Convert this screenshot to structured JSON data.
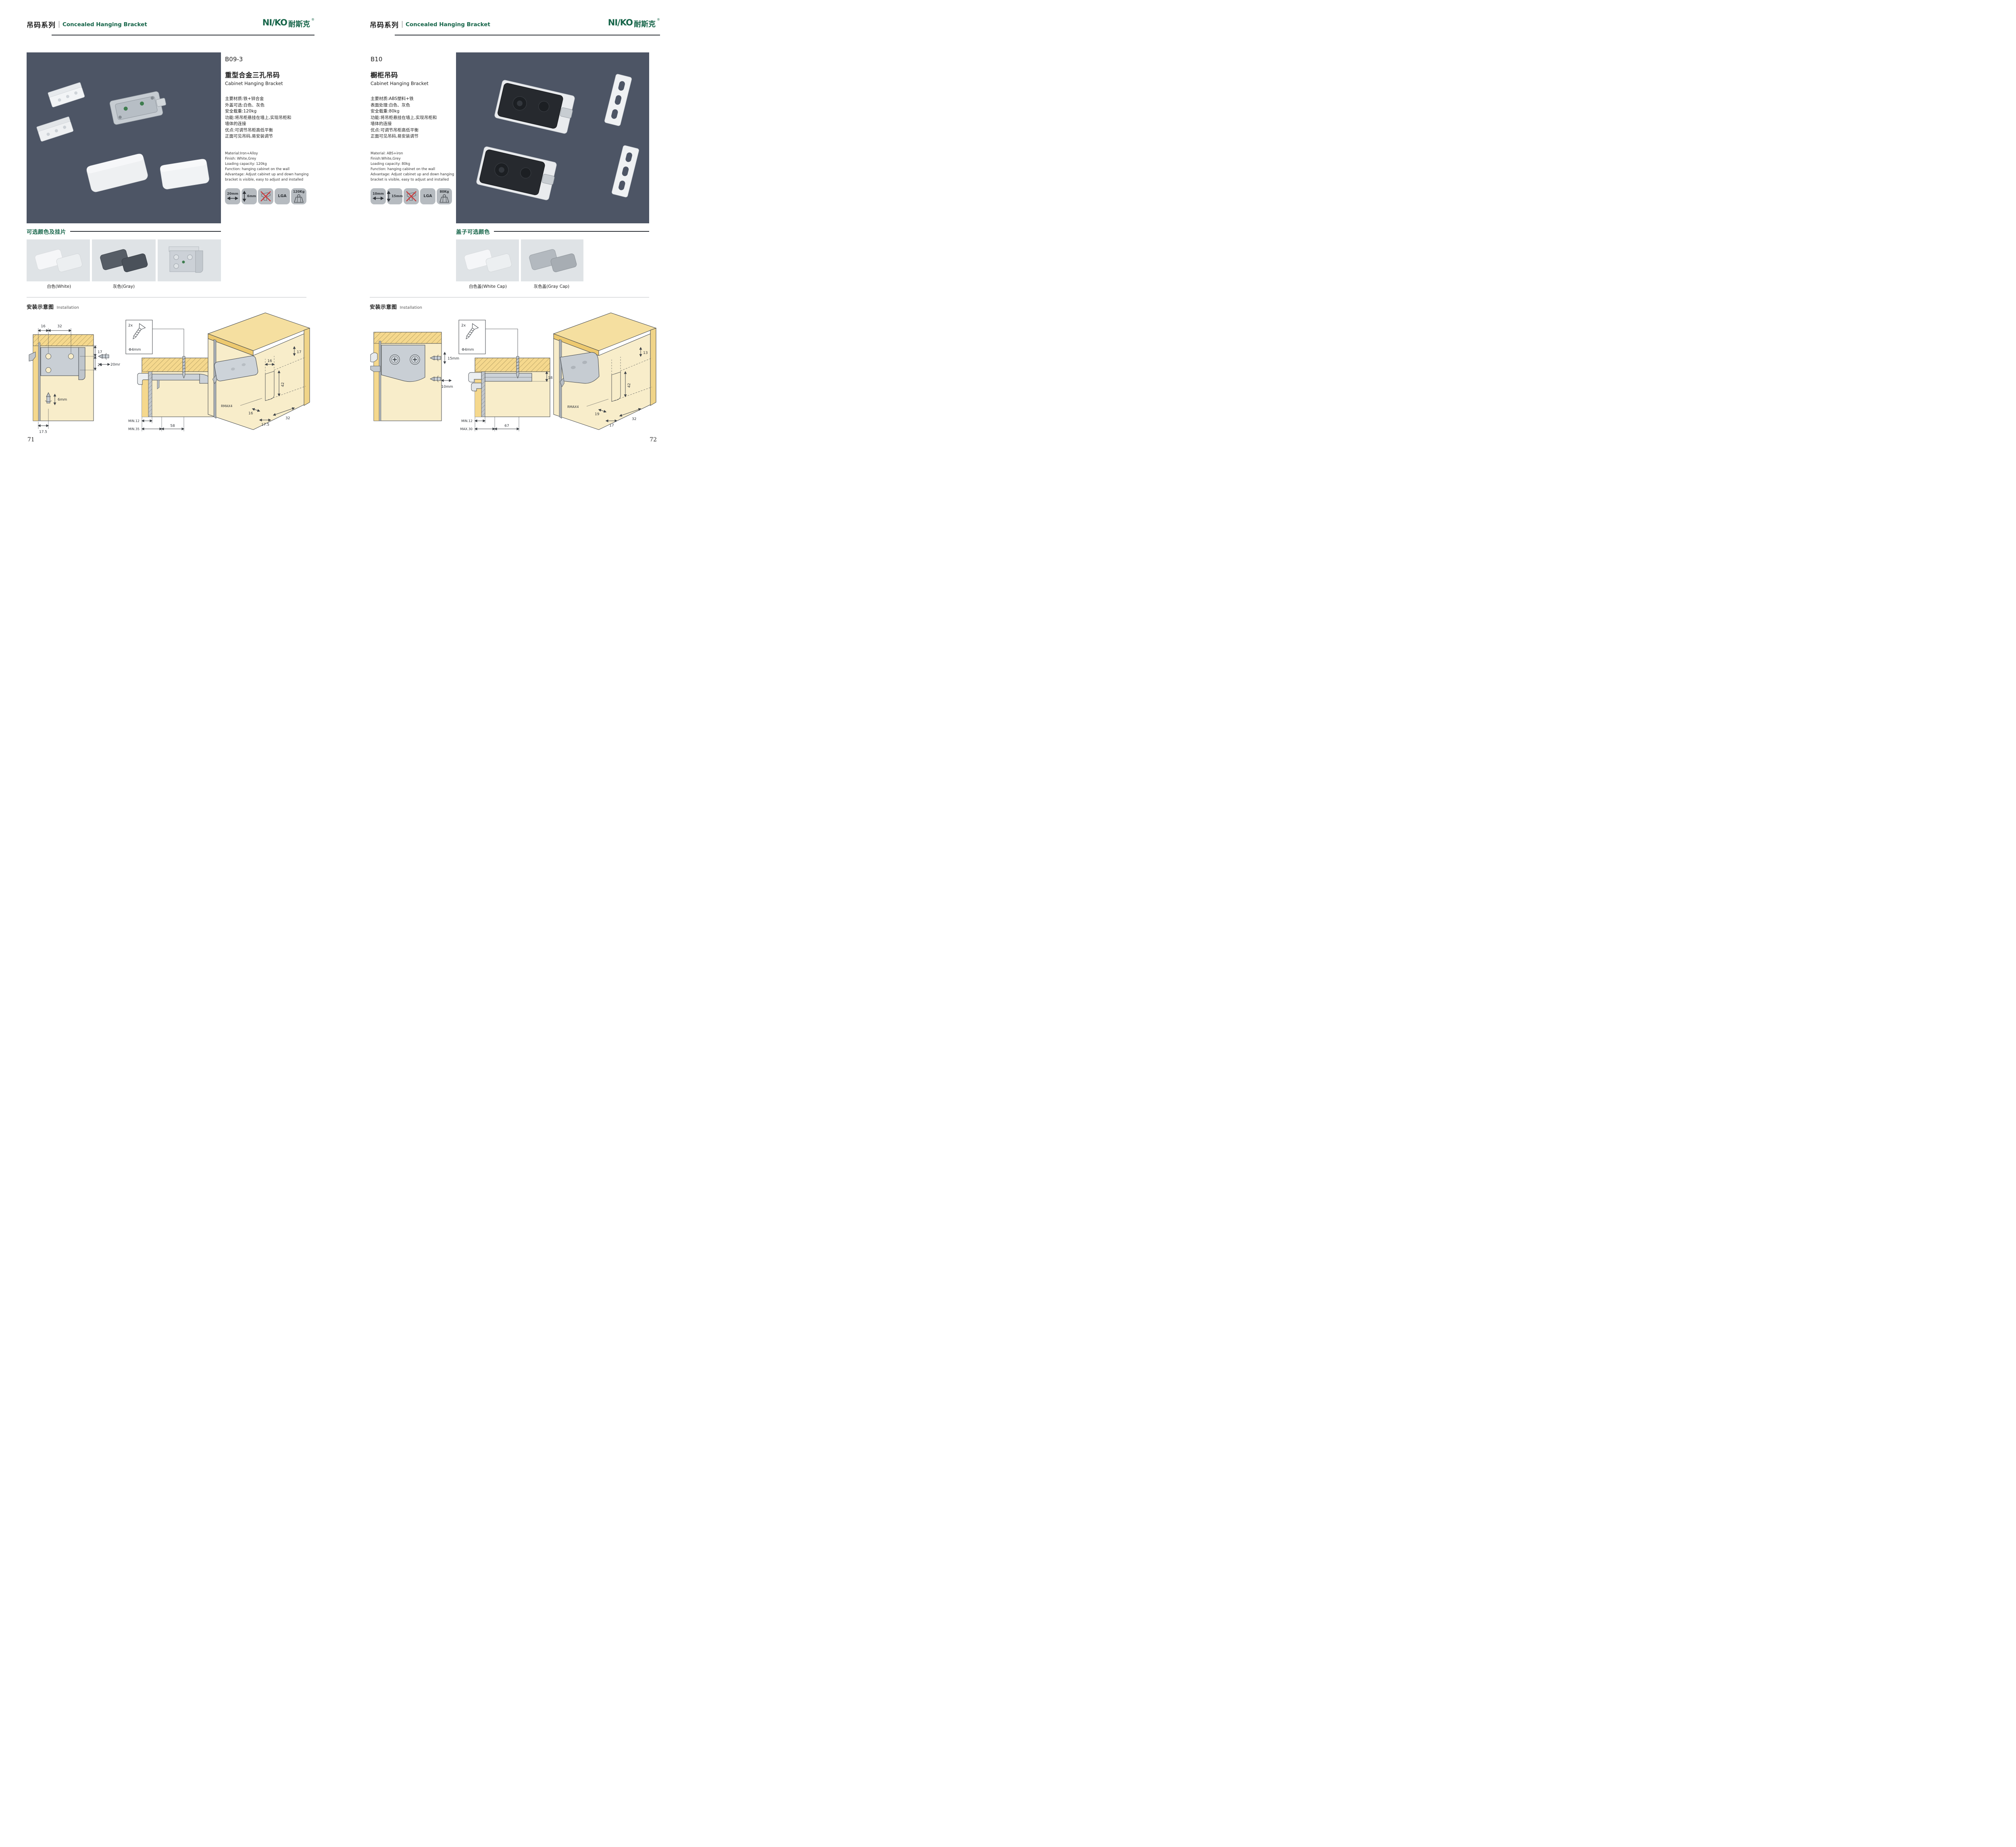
{
  "brand": {
    "logo_en": "NI/KO",
    "logo_cn": "耐斯克",
    "registered": "®",
    "green": "#166549"
  },
  "icons": {
    "badge_width": "double-arrow-horizontal",
    "badge_height": "double-arrow-vertical",
    "badge_no_drill": "drill-crossed-out",
    "badge_load": "weight",
    "screw": "countersunk-screw",
    "screwdriver_bit": "phillips-bit"
  },
  "left": {
    "header": {
      "series_cn": "吊码系列",
      "series_en": "Concealed Hanging Bracket"
    },
    "code": "B09-3",
    "name_cn": "重型合金三孔吊码",
    "name_en": "Cabinet Hanging Bracket",
    "specs_cn": [
      "主要材质:铁+锌合金",
      "外盖可选:白色、灰色",
      "安全载重:120kg",
      "功能:将吊柜悬挂在墙上,实现吊柜和",
      "墙体的连接",
      "优点:可调节吊柜高低平衡",
      "正面可见吊码,易安装调节"
    ],
    "specs_en": [
      "Material:Iron+Alloy",
      "Finish: White,Grey",
      "Loading capacity: 120kg",
      "Function: hanging cabinet on the wall",
      "Advantage: Adjust cabinet up and down hanging",
      "bracket is visible, easy to adjust and installed"
    ],
    "badges": {
      "width": "20mm",
      "height": "6mm",
      "cert": "LGA",
      "load": "120Kg"
    },
    "colors_title": "可选颜色及挂片",
    "swatch_labels": [
      "白色(White)",
      "灰色(Gray)",
      ""
    ],
    "install_title_cn": "安装示意图",
    "install_title_en": "Installation",
    "d1": {
      "w1": "16",
      "w2": "32",
      "h1": "17",
      "h2": "25",
      "side": "20mm",
      "depth": "6mm",
      "bottom": "17.5"
    },
    "d2": {
      "count": "2x",
      "dia": "Φ4mm",
      "h": "12",
      "row1": "MIN.12",
      "row2": "MIN.35",
      "span": "58"
    },
    "d3": {
      "slot_w": "16",
      "top": "17",
      "slot_h": "42",
      "radius": "RMAX4",
      "b1": "16",
      "b2": "17.5",
      "b3": "32"
    },
    "page_number": "71"
  },
  "right": {
    "header": {
      "series_cn": "吊码系列",
      "series_en": "Concealed Hanging Bracket"
    },
    "code": "B10",
    "name_cn": "橱柜吊码",
    "name_en": "Cabinet Hanging Bracket",
    "specs_cn": [
      "主要材质:ABS塑料+铁",
      "表面处理:白色、灰色",
      "安全载重:80kg",
      "功能:将吊柜悬挂在墙上,实现吊柜和",
      "墙体的连接",
      "优点:可调节吊柜高低平衡",
      "正面可见吊码,易安装调节"
    ],
    "specs_en": [
      "Material: ABS+iron",
      "Finish:White,Grey",
      "Loading capacity: 80kg",
      "Function: hanging cabinet on the wall",
      "Advantage: Adjust cabinet up and down hanging",
      "bracket is visible, easy to adjust and installed"
    ],
    "badges": {
      "width": "10mm",
      "height": "15mm",
      "cert": "LGA",
      "load": "80Kg"
    },
    "colors_title": "盖子可选颜色",
    "swatch_labels": [
      "白色盖(White Cap)",
      "灰色盖(Gray Cap)"
    ],
    "install_title_cn": "安装示意图",
    "install_title_en": "Installation",
    "d1": {
      "v": "15mm",
      "h": "10mm"
    },
    "d2": {
      "count": "2x",
      "dia": "Φ4mm",
      "h": "18",
      "row1": "MIN.12",
      "row2": "MAX.30",
      "span": "67"
    },
    "d3": {
      "top": "13",
      "slot_h": "42",
      "radius": "RMAX4",
      "b1": "19",
      "b2": "17",
      "b3": "32"
    },
    "page_number": "72"
  }
}
